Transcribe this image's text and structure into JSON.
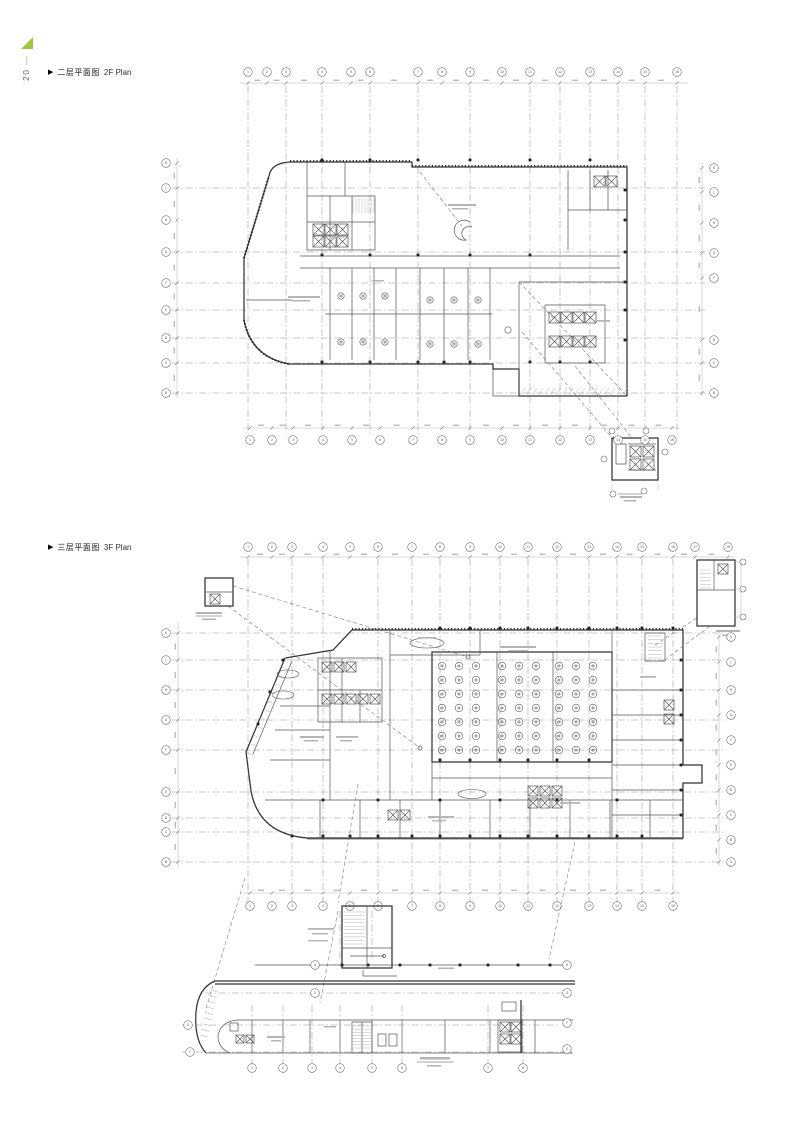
{
  "page": {
    "number": "20"
  },
  "colors": {
    "logo": "#9bc83e",
    "line": "#555555",
    "accent_dark": "#222222"
  },
  "sections": [
    {
      "marker": "▶",
      "title_zh": "二层平面图",
      "title_en": "2F Plan"
    },
    {
      "marker": "▶",
      "title_zh": "三层平面图",
      "title_en": "3F Plan"
    }
  ],
  "plan1": {
    "grid_top": [
      "1",
      "2",
      "3",
      "4",
      "5",
      "6",
      "7",
      "8",
      "9",
      "10",
      "11",
      "12",
      "13",
      "14",
      "15",
      "16"
    ],
    "grid_bottom": [
      "1",
      "2",
      "3",
      "4",
      "5",
      "6",
      "7",
      "8",
      "9",
      "10",
      "11",
      "12",
      "13",
      "14",
      "15",
      "16"
    ],
    "grid_left": [
      "K",
      "J",
      "H",
      "G",
      "F",
      "E",
      "D",
      "C",
      "B"
    ],
    "grid_right": [
      "K",
      "J",
      "H",
      "G",
      "F",
      "D",
      "C",
      "B"
    ]
  },
  "plan2": {
    "grid_top": [
      "1",
      "2",
      "3",
      "4",
      "5",
      "6",
      "7",
      "8",
      "9",
      "10",
      "11",
      "12",
      "13",
      "14",
      "15",
      "16",
      "17",
      "18"
    ],
    "grid_bottom": [
      "1",
      "2",
      "3",
      "4",
      "5",
      "6",
      "7",
      "8",
      "9",
      "10",
      "11",
      "12",
      "13",
      "14",
      "15",
      "16"
    ],
    "grid_left": [
      "K",
      "J",
      "H",
      "G",
      "F",
      "E",
      "D",
      "C",
      "B"
    ],
    "grid_right": [
      "K",
      "J",
      "H",
      "G",
      "F",
      "E",
      "D",
      "C",
      "B",
      "A"
    ]
  },
  "strip": {
    "grid_bottom": [
      "1",
      "2",
      "3",
      "4",
      "5",
      "6",
      "7",
      "8"
    ],
    "grid_left": [
      "G",
      "F"
    ],
    "grid_right": [
      "H",
      "G",
      "F",
      "E"
    ],
    "grid_mid": [
      "4",
      "5"
    ]
  }
}
